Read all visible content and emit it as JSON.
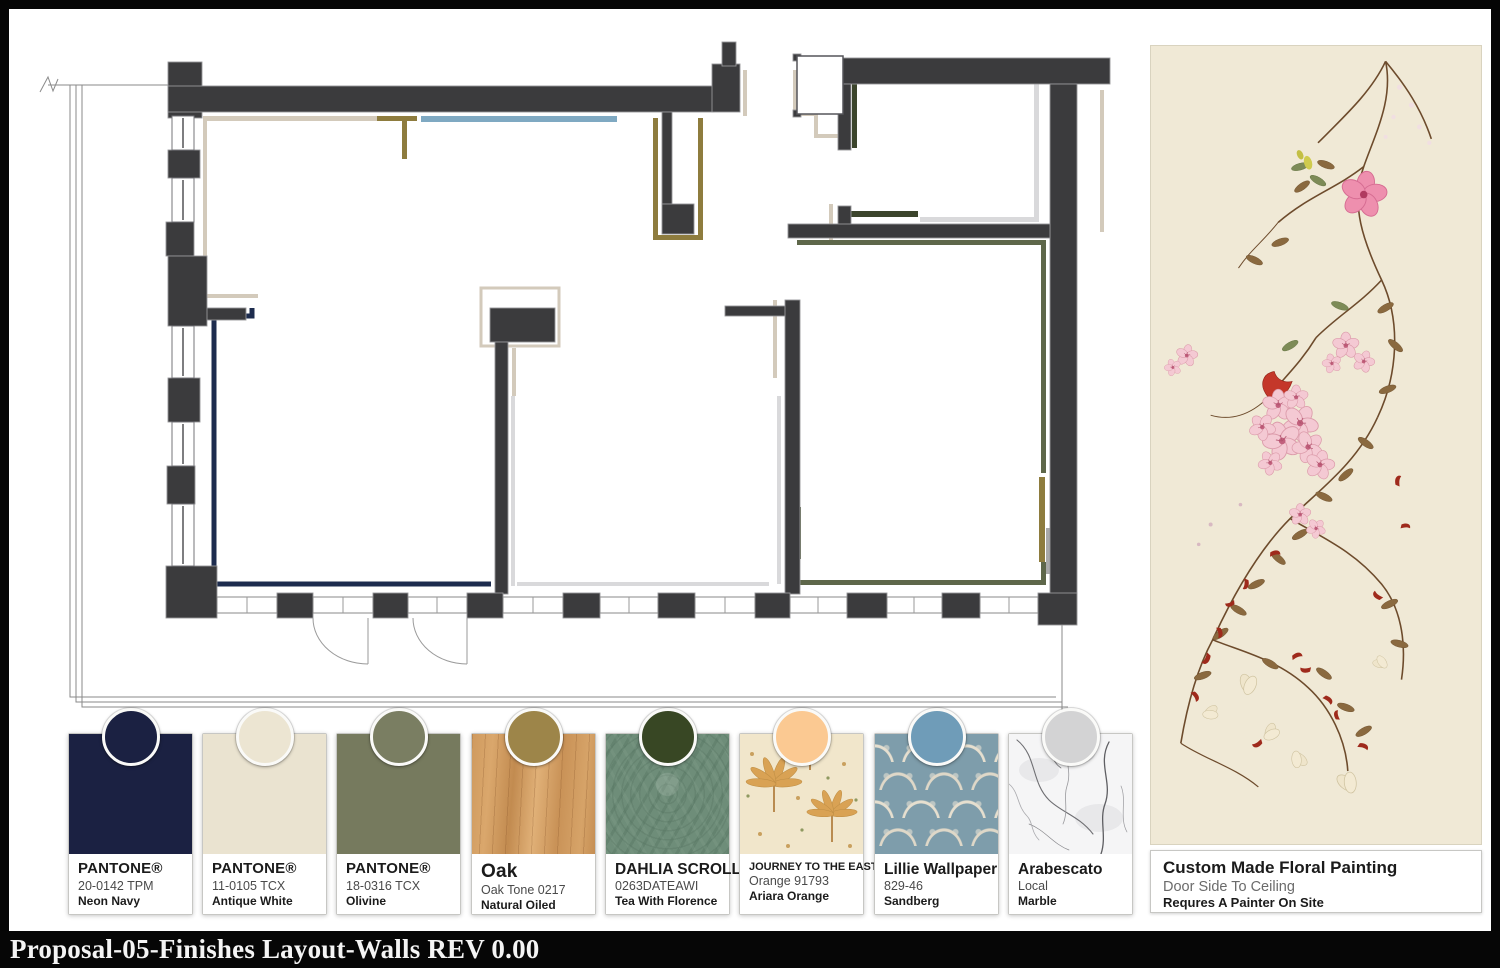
{
  "title_bar": {
    "text": "Proposal-05-Finishes Layout-Walls REV 0.00"
  },
  "swatches": [
    {
      "id": "neon-navy",
      "line1": "PANTONE®",
      "line2": "20-0142 TPM",
      "line3": "Neon Navy",
      "dot_color": "#1b2142",
      "chip_color": "#1b2142",
      "type": "solid"
    },
    {
      "id": "antique-white",
      "line1": "PANTONE®",
      "line2": "11-0105 TCX",
      "line3": "Antique White",
      "dot_color": "#ece5d2",
      "chip_color": "#eae3d0",
      "type": "solid"
    },
    {
      "id": "olivine",
      "line1": "PANTONE®",
      "line2": "18-0316 TCX",
      "line3": "Olivine",
      "dot_color": "#7a7e62",
      "chip_color": "#767a5e",
      "type": "solid"
    },
    {
      "id": "oak",
      "line1": "Oak",
      "line2": "Oak Tone 0217",
      "line3": "Natural Oiled",
      "dot_color": "#9d8549",
      "type": "wood"
    },
    {
      "id": "dahlia-scroll",
      "line1": "DAHLIA SCROLL",
      "line2": "0263DATEAWI",
      "line3": "Tea With Florence",
      "dot_color": "#384724",
      "type": "green-damask"
    },
    {
      "id": "journey-to-the-east",
      "line1": "JOURNEY TO THE EAST",
      "line2": "Orange 91793",
      "line3": "Ariara Orange",
      "dot_color": "#fbc992",
      "type": "palm-print"
    },
    {
      "id": "lillie",
      "line1": "Lillie Wallpaper",
      "line2": "829-46",
      "line3": "Sandberg",
      "dot_color": "#6f9cb8",
      "type": "blue-ogee"
    },
    {
      "id": "arabescato",
      "line1": "Arabescato",
      "line2": "Local",
      "line3": "Marble",
      "dot_color": "#d3d3d4",
      "type": "marble"
    }
  ],
  "painting": {
    "title": "Custom Made Floral Painting",
    "subtitle": "Door Side To Ceiling",
    "note": "Requres A Painter On Site"
  },
  "plan": {
    "accent_colors": {
      "wall": "#3b3b3d",
      "greige": "#d3cabb",
      "navy": "#1d2c4e",
      "olive_dark": "#3c452c",
      "olive": "#5e674a",
      "gold": "#8e7c3e",
      "steel_blue": "#7fa9c2",
      "orange": "#f7c289",
      "light_gray": "#d9d9db"
    }
  }
}
